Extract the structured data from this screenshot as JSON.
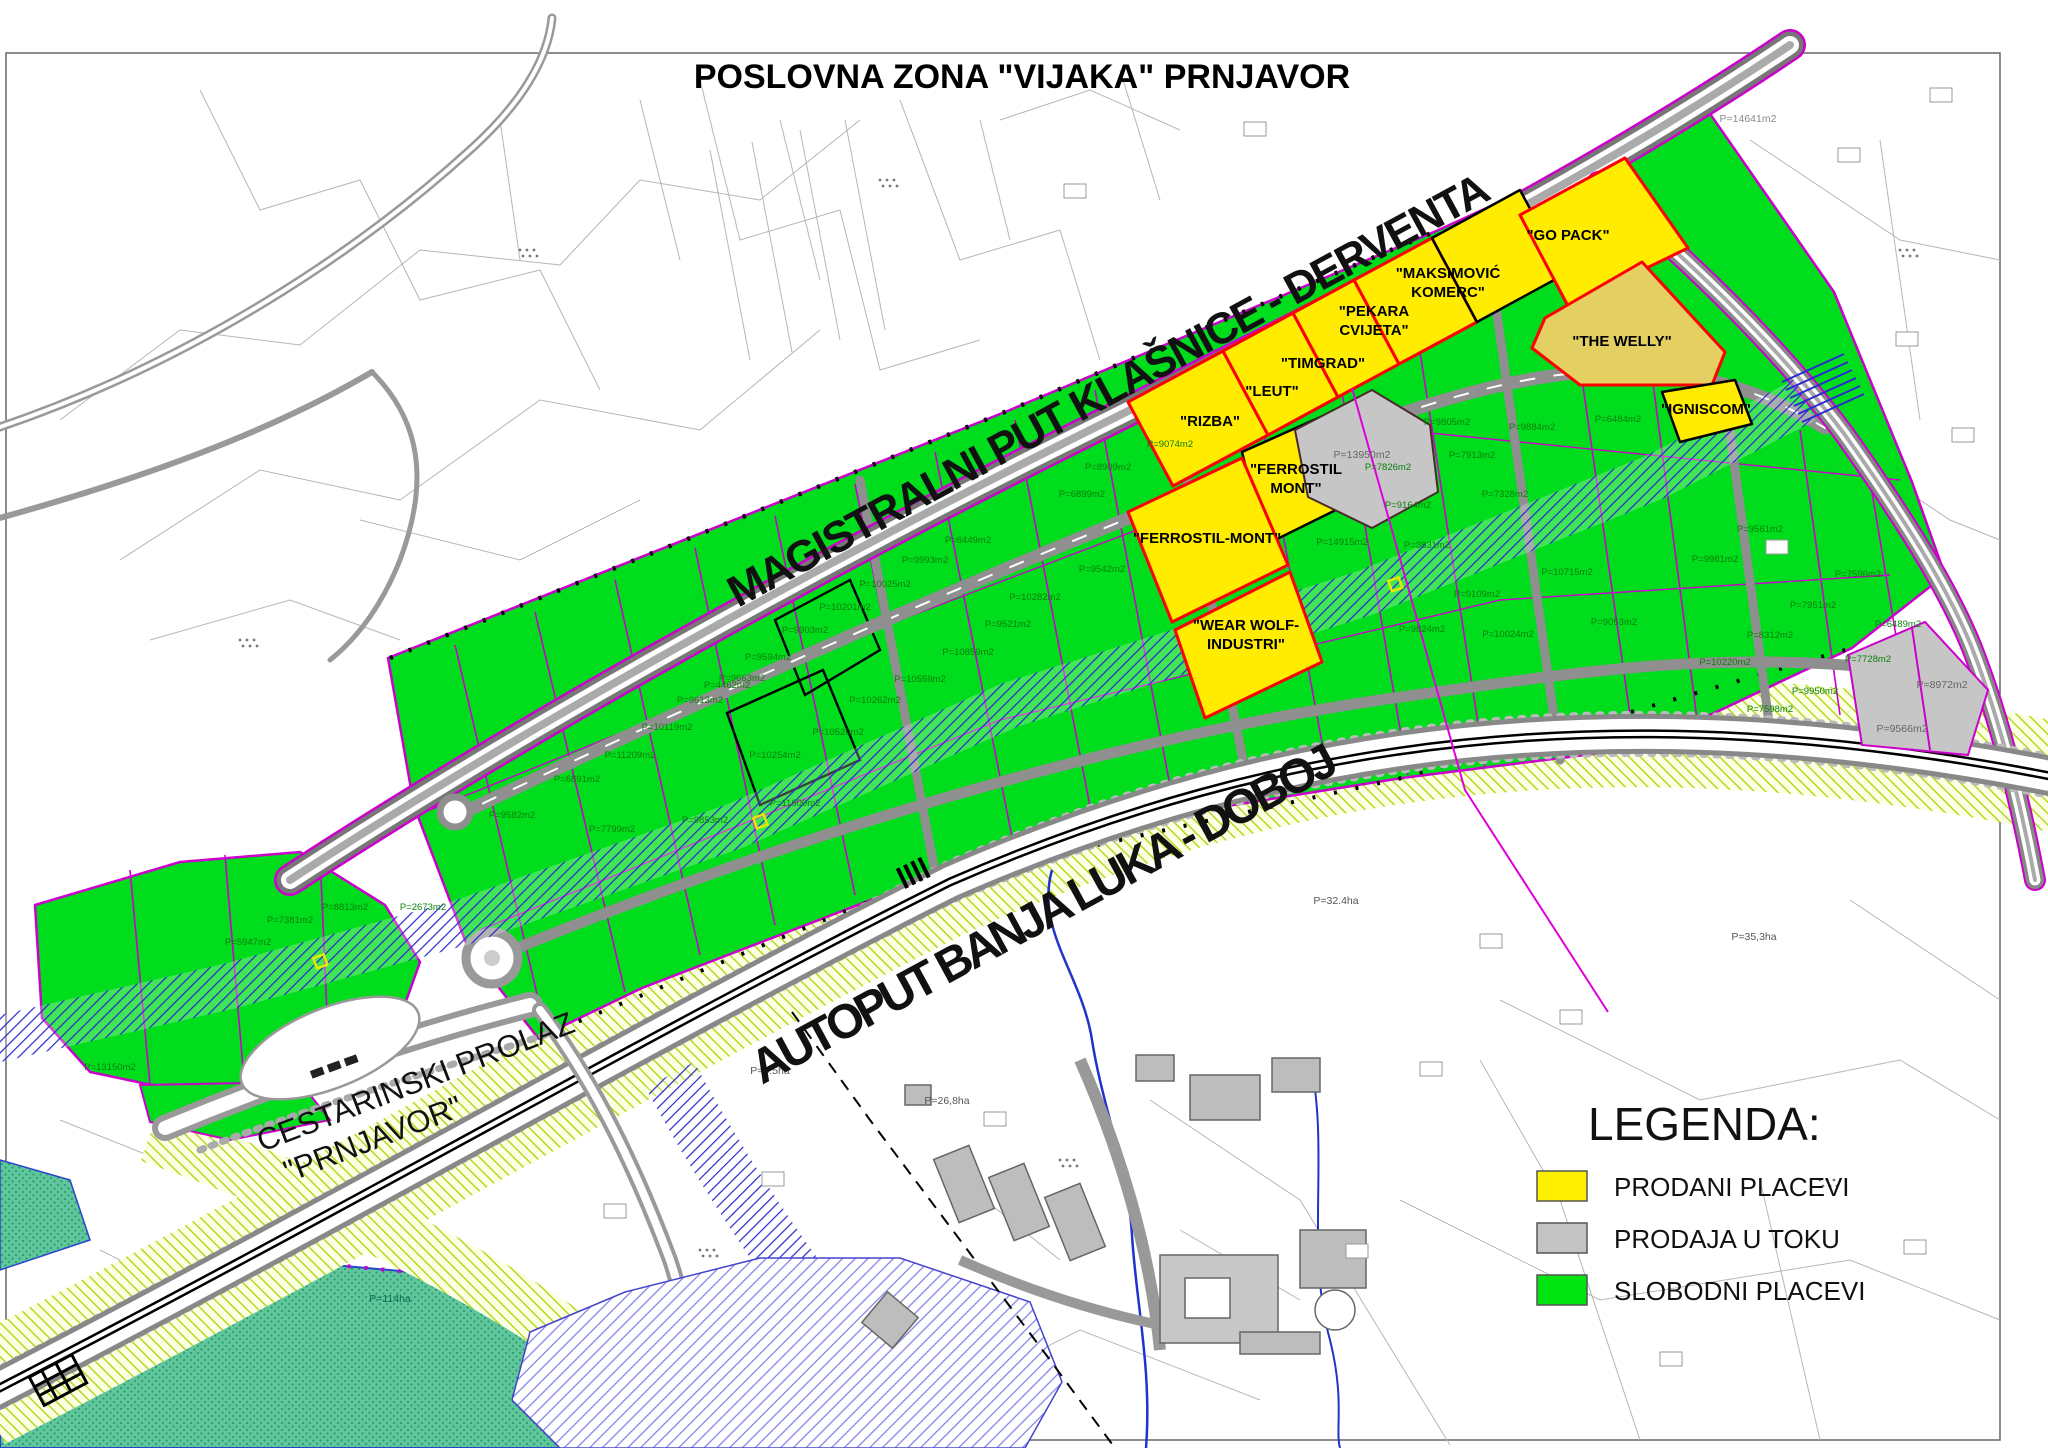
{
  "title": "POSLOVNA ZONA \"VIJAKA\" PRNJAVOR",
  "road_labels": {
    "magistralni": "MAGISTRALNI PUT KLAŠNICE - DERVENTA",
    "autoput": "AUTOPUT BANJA LUKA - DOBOJ",
    "cestarinski_line1": "CESTARINSKI PROLAZ",
    "cestarinski_line2": "\"PRNJAVOR\""
  },
  "legend": {
    "title": "LEGENDA:",
    "items": [
      {
        "label": "PRODANI PLACEVI",
        "color": "#fff000",
        "status": "sold"
      },
      {
        "label": "PRODAJA U TOKU",
        "color": "#c3c3c3",
        "status": "sale-in-progress"
      },
      {
        "label": "SLOBODNI PLACEVI",
        "color": "#00e412",
        "status": "free"
      }
    ]
  },
  "colors": {
    "sold_parcel": "#ffec00",
    "sold_parcel_special": "#e4cf63",
    "pending_parcel": "#c6c6c6",
    "free_parcel": "#00dd1c",
    "sold_border_red": "#ff0000",
    "parcel_line_magenta": "#cc00cc",
    "road_gray": "#8f8f8f",
    "water_blue": "#2727cf",
    "corridor_hatch_green": "#b5d920",
    "wetland_teal": "#5fc79b"
  },
  "company_labels": [
    {
      "lines": [
        "\"RIZBA\""
      ],
      "x": 1210,
      "y": 426
    },
    {
      "lines": [
        "\"LEUT\""
      ],
      "x": 1272,
      "y": 396
    },
    {
      "lines": [
        "\"TIMGRAD\""
      ],
      "x": 1323,
      "y": 368
    },
    {
      "lines": [
        "\"PEKARA",
        "CVIJETA\""
      ],
      "x": 1374,
      "y": 316
    },
    {
      "lines": [
        "\"MAKSIMOVIĆ",
        "KOMERC\""
      ],
      "x": 1448,
      "y": 278
    },
    {
      "lines": [
        "\"GO PACK\""
      ],
      "x": 1568,
      "y": 240
    },
    {
      "lines": [
        "\"THE WELLY\""
      ],
      "x": 1622,
      "y": 346
    },
    {
      "lines": [
        "\"IGNISCOM\""
      ],
      "x": 1706,
      "y": 414,
      "fs": 13
    },
    {
      "lines": [
        "\"FERROSTIL",
        "MONT\""
      ],
      "x": 1296,
      "y": 474
    },
    {
      "lines": [
        "\"FERROSTIL-MONT\""
      ],
      "x": 1207,
      "y": 543
    },
    {
      "lines": [
        "\"WEAR WOLF-",
        "INDUSTRI\""
      ],
      "x": 1246,
      "y": 630
    }
  ],
  "green_labels": [
    {
      "t": "P=9582m2",
      "x": 512,
      "y": 818
    },
    {
      "t": "P=6891m2",
      "x": 577,
      "y": 782
    },
    {
      "t": "P=11209m2",
      "x": 630,
      "y": 758
    },
    {
      "t": "P=10119m2",
      "x": 667,
      "y": 730
    },
    {
      "t": "P=9613m2",
      "x": 700,
      "y": 703
    },
    {
      "t": "P=9663m2",
      "x": 742,
      "y": 681
    },
    {
      "t": "P=7799m2",
      "x": 612,
      "y": 832
    },
    {
      "t": "P=9853m2",
      "x": 705,
      "y": 823
    },
    {
      "t": "P=9594m2",
      "x": 768,
      "y": 660
    },
    {
      "t": "P=9903m2",
      "x": 805,
      "y": 633
    },
    {
      "t": "P=10201m2",
      "x": 845,
      "y": 610
    },
    {
      "t": "P=10025m2",
      "x": 885,
      "y": 587
    },
    {
      "t": "P=9993m2",
      "x": 925,
      "y": 563
    },
    {
      "t": "P=6449m2",
      "x": 968,
      "y": 543
    },
    {
      "t": "P=4462m2",
      "x": 727,
      "y": 688
    },
    {
      "t": "P=10254m2",
      "x": 775,
      "y": 758
    },
    {
      "t": "P=11600m2",
      "x": 795,
      "y": 806
    },
    {
      "t": "P=10520m2",
      "x": 838,
      "y": 735
    },
    {
      "t": "P=10262m2",
      "x": 875,
      "y": 703
    },
    {
      "t": "P=10559m2",
      "x": 920,
      "y": 682
    },
    {
      "t": "P=10859m2",
      "x": 968,
      "y": 655
    },
    {
      "t": "P=9521m2",
      "x": 1008,
      "y": 627
    },
    {
      "t": "P=9074m2",
      "x": 1170,
      "y": 447
    },
    {
      "t": "P=8909m2",
      "x": 1108,
      "y": 470
    },
    {
      "t": "P=6899m2",
      "x": 1082,
      "y": 497
    },
    {
      "t": "P=9542m2",
      "x": 1102,
      "y": 572
    },
    {
      "t": "P=14915m2",
      "x": 1342,
      "y": 545
    },
    {
      "t": "P=9164m2",
      "x": 1408,
      "y": 508
    },
    {
      "t": "P=7826m2",
      "x": 1388,
      "y": 470
    },
    {
      "t": "P=7913m2",
      "x": 1472,
      "y": 458
    },
    {
      "t": "P=7328m2",
      "x": 1505,
      "y": 497
    },
    {
      "t": "P=9805m2",
      "x": 1447,
      "y": 425
    },
    {
      "t": "P=9884m2",
      "x": 1532,
      "y": 430
    },
    {
      "t": "P=6484m2",
      "x": 1618,
      "y": 422
    },
    {
      "t": "P=3831m2",
      "x": 1427,
      "y": 548
    },
    {
      "t": "P=9109m2",
      "x": 1477,
      "y": 597
    },
    {
      "t": "P=10715m2",
      "x": 1567,
      "y": 575
    },
    {
      "t": "P=9053m2",
      "x": 1614,
      "y": 625
    },
    {
      "t": "P=9824m2",
      "x": 1422,
      "y": 632
    },
    {
      "t": "P=10024m2",
      "x": 1508,
      "y": 637
    },
    {
      "t": "P=9981m2",
      "x": 1715,
      "y": 562
    },
    {
      "t": "P=9561m2",
      "x": 1760,
      "y": 532
    },
    {
      "t": "P=7951m2",
      "x": 1813,
      "y": 608
    },
    {
      "t": "P=6489m2",
      "x": 1898,
      "y": 627
    },
    {
      "t": "P=7596m2",
      "x": 1858,
      "y": 577
    },
    {
      "t": "P=8312m2",
      "x": 1770,
      "y": 638
    },
    {
      "t": "P=10220m2",
      "x": 1725,
      "y": 665
    },
    {
      "t": "P=9950m2",
      "x": 1815,
      "y": 694
    },
    {
      "t": "P=7728m2",
      "x": 1868,
      "y": 662
    },
    {
      "t": "P=7598m2",
      "x": 1770,
      "y": 712
    },
    {
      "t": "P=13150m2",
      "x": 110,
      "y": 1070
    },
    {
      "t": "P=5947m2",
      "x": 248,
      "y": 945
    },
    {
      "t": "P=7381m2",
      "x": 290,
      "y": 923
    },
    {
      "t": "P=8813m2",
      "x": 345,
      "y": 910
    },
    {
      "t": "P=2673m2",
      "x": 423,
      "y": 910
    },
    {
      "t": "P=10282m2",
      "x": 1035,
      "y": 600
    }
  ],
  "misc_labels": [
    {
      "t": "P=13950m2",
      "x": 1362,
      "y": 458,
      "c": "#666666"
    },
    {
      "t": "P=8972m2",
      "x": 1942,
      "y": 688,
      "c": "#666666"
    },
    {
      "t": "P=9566m2",
      "x": 1902,
      "y": 732,
      "c": "#666666"
    },
    {
      "t": "P=114ha",
      "x": 390,
      "y": 1302,
      "c": "#0a6b52"
    },
    {
      "t": "P=32.4ha",
      "x": 1336,
      "y": 904,
      "c": "#555555"
    },
    {
      "t": "P=35,3ha",
      "x": 1754,
      "y": 940,
      "c": "#555555"
    },
    {
      "t": "P=6.5ha",
      "x": 770,
      "y": 1074,
      "c": "#555555"
    },
    {
      "t": "P=26,8ha",
      "x": 947,
      "y": 1104,
      "c": "#555555"
    },
    {
      "t": "P=14641m2",
      "x": 1748,
      "y": 122,
      "c": "#888888"
    }
  ],
  "tiny_boxes": [
    [
      1838,
      148
    ],
    [
      1896,
      332
    ],
    [
      1952,
      428
    ],
    [
      1766,
      540
    ],
    [
      1930,
      88
    ],
    [
      1480,
      934
    ],
    [
      1346,
      1244
    ],
    [
      1660,
      1352
    ],
    [
      762,
      1172
    ],
    [
      984,
      1112
    ],
    [
      604,
      1204
    ],
    [
      1244,
      122
    ],
    [
      1064,
      184
    ],
    [
      1560,
      1010
    ],
    [
      1420,
      1062
    ],
    [
      1904,
      1240
    ]
  ]
}
